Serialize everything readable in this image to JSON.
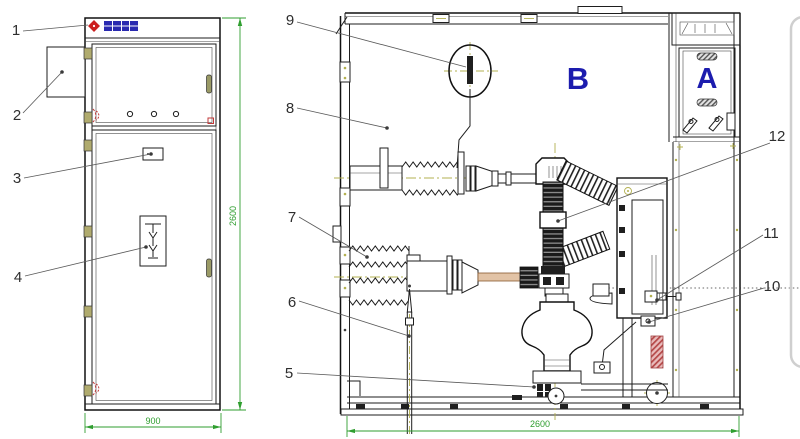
{
  "drawing": {
    "front_view": {
      "callouts": [
        "1",
        "2",
        "3",
        "4"
      ],
      "width_dim": "900",
      "height_dim": "2600"
    },
    "side_view": {
      "callouts": [
        "5",
        "6",
        "7",
        "8",
        "9",
        "10",
        "11",
        "12"
      ],
      "width_dim": "2600",
      "compartment_a_label": "A",
      "compartment_b_label": "B"
    },
    "colors": {
      "line": "#1e1e1e",
      "dimension_green": "#2f9e2f",
      "centerline_olive": "#b3b050",
      "compartment_blue": "#1c1cae",
      "brand_red": "#cc2020",
      "brand_blue": "#2a2ab0",
      "spring_red": "#b54848"
    }
  }
}
